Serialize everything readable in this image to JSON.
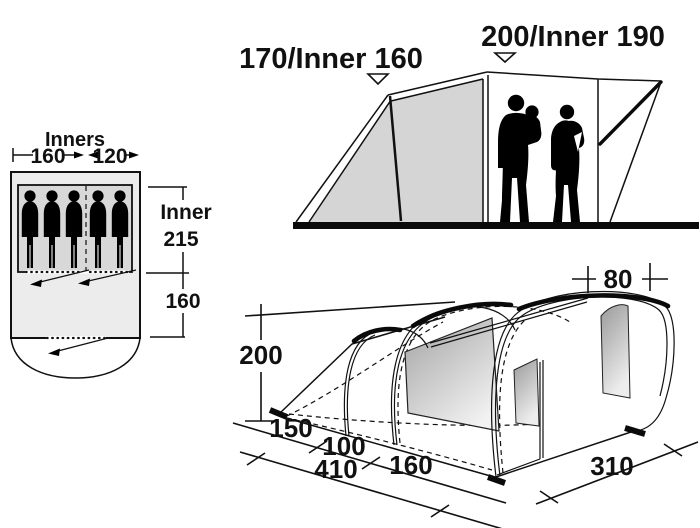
{
  "floorplan": {
    "title": "Inners",
    "inner_widths": {
      "left": "160",
      "right": "120"
    },
    "depths": {
      "inner_label": "Inner",
      "inner_value": "215",
      "living": "160"
    }
  },
  "elevation": {
    "awning_height": "170/Inner 160",
    "main_height": "200/Inner 190"
  },
  "perspective": {
    "height": "200",
    "roof_overhang": "80",
    "length_segments": {
      "porch": "150",
      "mid": "100",
      "front": "160"
    },
    "length_total": "410",
    "width": "310"
  },
  "colors": {
    "line": "#111111",
    "panel_gray": "#d5d5d5",
    "floor_fill": "#ececec",
    "inner_fill": "#d8d8d8"
  }
}
